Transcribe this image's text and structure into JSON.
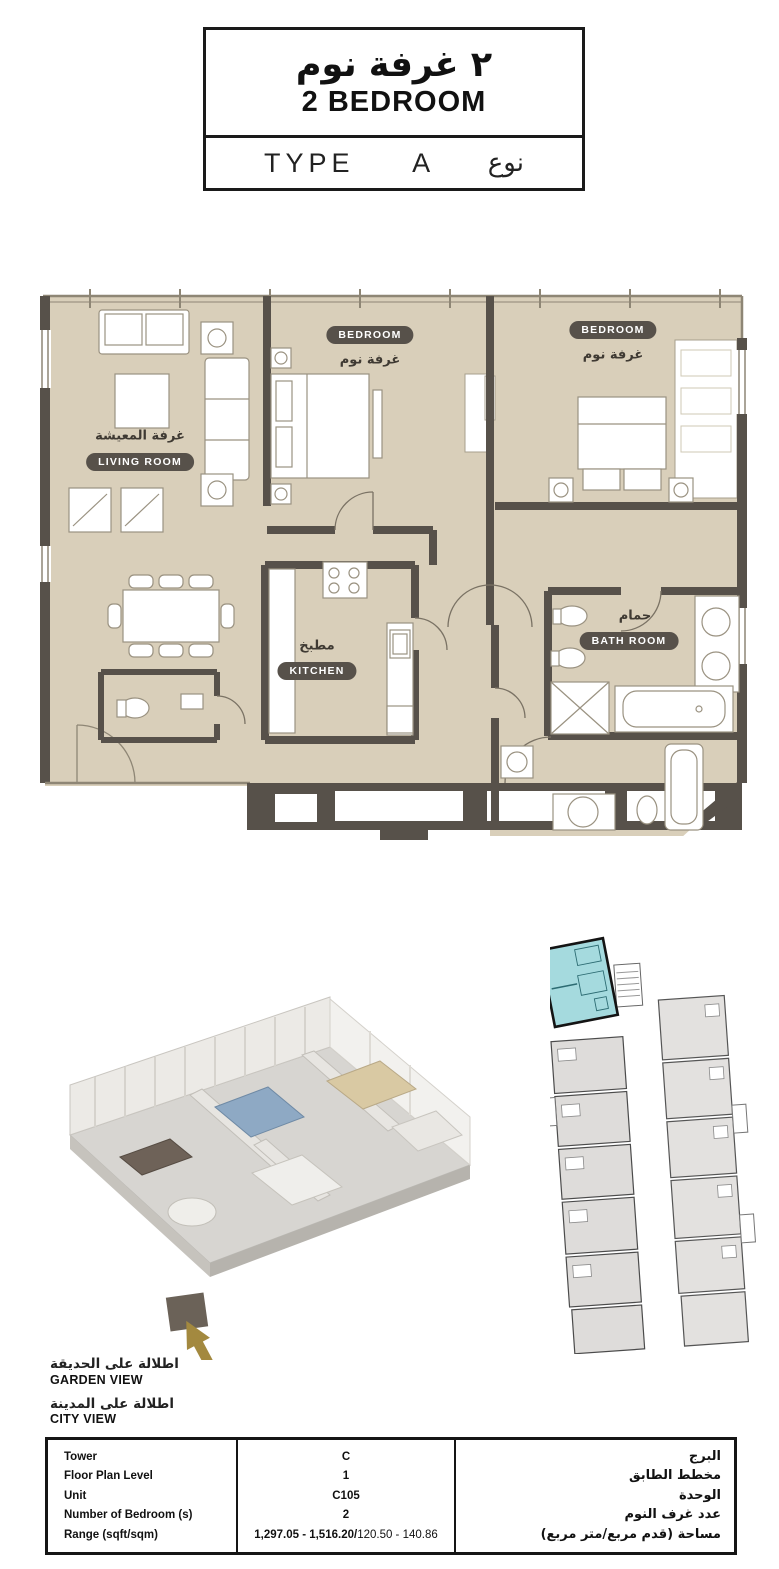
{
  "title_block": {
    "arabic": "٢ غرفة نوم",
    "english": "2 BEDROOM",
    "type_label": "TYPE",
    "type_value": "A",
    "type_arabic": "نوع"
  },
  "floor_plan": {
    "rooms": [
      {
        "id": "living-room",
        "en": "LIVING ROOM",
        "ar": "غرفة المعيشة"
      },
      {
        "id": "bedroom-1",
        "en": "BEDROOM",
        "ar": "غرفة نوم"
      },
      {
        "id": "bedroom-2",
        "en": "BEDROOM",
        "ar": "غرفة نوم"
      },
      {
        "id": "kitchen",
        "en": "KITCHEN",
        "ar": "مطبخ"
      },
      {
        "id": "bathroom",
        "en": "BATH ROOM",
        "ar": "حمام"
      }
    ]
  },
  "views": [
    {
      "ar": "اطلالة على الحديقة",
      "en": "GARDEN VIEW"
    },
    {
      "ar": "اطلالة على المدينة",
      "en": "CITY VIEW"
    }
  ],
  "details_table": {
    "rows": [
      {
        "label": "Tower",
        "value": "C",
        "ar": "البرج"
      },
      {
        "label": "Floor Plan Level",
        "value": "1",
        "ar": "مخطط الطابق"
      },
      {
        "label": "Unit",
        "value": "C105",
        "ar": "الوحدة"
      },
      {
        "label": "Number of Bedroom (s)",
        "value": "2",
        "ar": "عدد غرف النوم"
      },
      {
        "label": "Range (sqft/sqm)",
        "value_bold": "1,297.05 - 1,516.20/",
        "value_regular": "120.50 - 140.86",
        "ar": "مساحة (قدم مربع/متر مربع)"
      }
    ]
  },
  "colors": {
    "floor_beige": "#d9cfba",
    "wall_dark": "#57514a",
    "highlight_unit_cyan": "#a5dade",
    "arrow_gold": "#a3893f"
  }
}
